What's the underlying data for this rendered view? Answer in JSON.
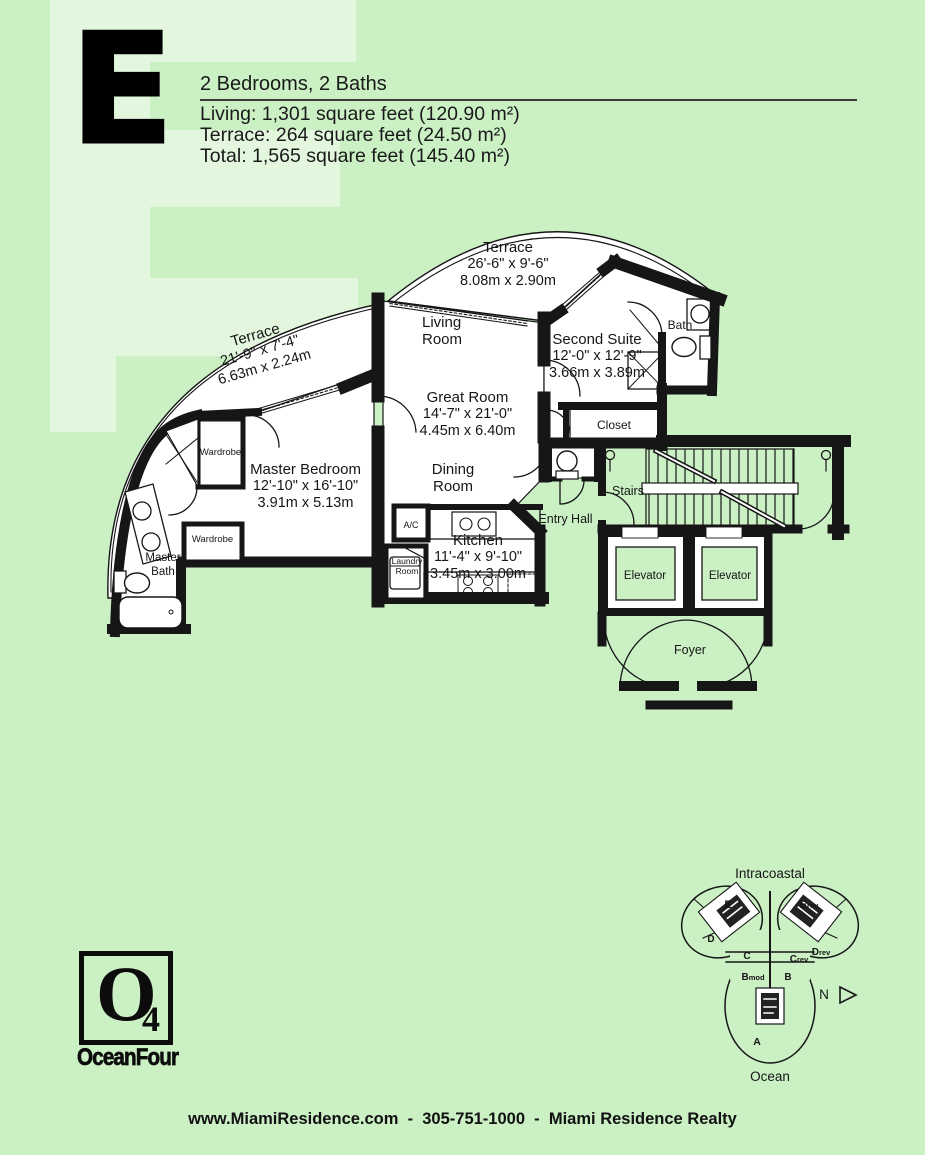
{
  "colors": {
    "background": "#caf0c4",
    "watermark": "#e2f7dd",
    "ink": "#141414",
    "white": "#ffffff"
  },
  "header": {
    "unit_letter": "E",
    "subtitle": "2 Bedrooms, 2 Baths",
    "stats": [
      "Living: 1,301 square feet (120.90 m²)",
      "Terrace: 264 square feet (24.50 m²)",
      "Total: 1,565 square feet (145.40 m²)"
    ]
  },
  "floorplan": {
    "terrace_top": {
      "name": "Terrace",
      "dim_ft": "26'-6\" x 9'-6\"",
      "dim_m": "8.08m x 2.90m"
    },
    "terrace_left": {
      "name": "Terrace",
      "dim_ft": "21'-9\" x 7'-4\"",
      "dim_m": "6.63m x 2.24m"
    },
    "living_room": {
      "line1": "Living",
      "line2": "Room"
    },
    "great_room": {
      "name": "Great Room",
      "dim_ft": "14'-7\" x 21'-0\"",
      "dim_m": "4.45m x 6.40m"
    },
    "second_suite": {
      "name": "Second Suite",
      "dim_ft": "12'-0\" x 12'-9\"",
      "dim_m": "3.66m x 3.89m"
    },
    "master_bedroom": {
      "name": "Master Bedroom",
      "dim_ft": "12'-10\" x 16'-10\"",
      "dim_m": "3.91m x 5.13m"
    },
    "dining_room": {
      "line1": "Dining",
      "line2": "Room"
    },
    "kitchen": {
      "name": "Kitchen",
      "dim_ft": "11'-4\" x 9'-10\"",
      "dim_m": "3.45m x 3.00m"
    },
    "bath": "Bath",
    "master_bath": {
      "line1": "Master",
      "line2": "Bath"
    },
    "closet": "Closet",
    "wardrobe_1": "Wardrobe",
    "wardrobe_2": "Wardrobe",
    "ac": "A/C",
    "laundry": {
      "line1": "Laundry",
      "line2": "Room"
    },
    "entry_hall": "Entry Hall",
    "stairs": "Stairs",
    "elevator_1": "Elevator",
    "elevator_2": "Elevator",
    "foyer": "Foyer"
  },
  "site_map": {
    "water_top": "Intracoastal",
    "water_bottom": "Ocean",
    "north_label": "N",
    "units": {
      "e": "E",
      "e_rev_main": "E",
      "e_rev_sub": "rev",
      "d": "D",
      "d_rev_main": "D",
      "d_rev_sub": "rev",
      "c": "C",
      "c_rev_main": "C",
      "c_rev_sub": "rev",
      "b_mod_main": "B",
      "b_mod_sub": "mod",
      "b": "B",
      "a": "A"
    }
  },
  "logo": {
    "letter": "O",
    "subscript": "4",
    "name": "OceanFour"
  },
  "footer": {
    "text": "www.MiamiResidence.com  -  305-751-1000  -  Miami Residence Realty"
  }
}
